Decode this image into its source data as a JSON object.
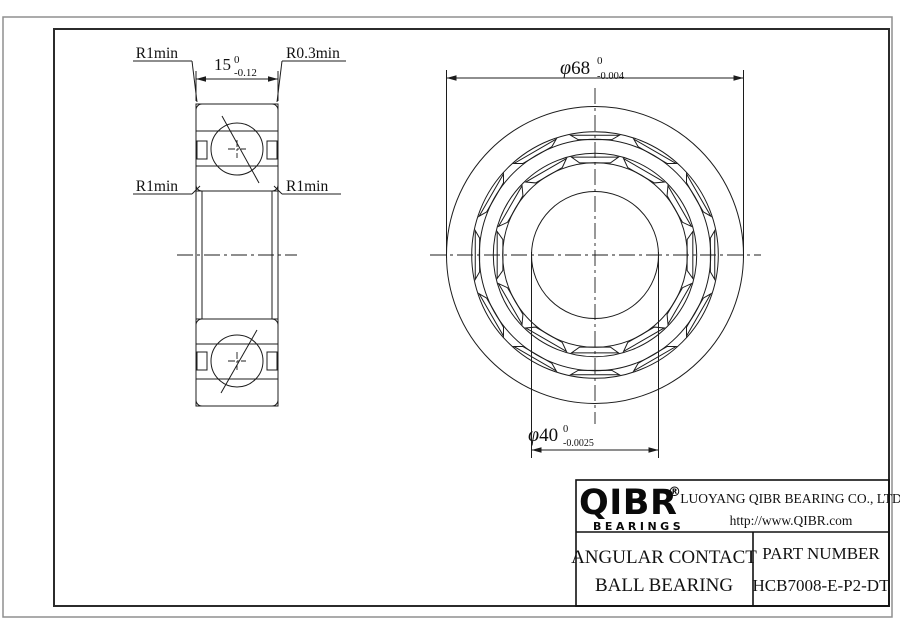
{
  "colors": {
    "line": "#1c1c1c",
    "frame_outer": "#8f8f8f",
    "frame_inner": "#2b2b2b",
    "background": "#ffffff"
  },
  "side_view": {
    "width_dim": {
      "nominal": "15",
      "tol_upper": "0",
      "tol_lower": "-0.12"
    },
    "fillet_labels": {
      "top_left": "R1min",
      "top_right": "R0.3min",
      "mid_left": "R1min",
      "mid_right": "R1min"
    }
  },
  "front_view": {
    "outer_dia": {
      "symbol": "φ",
      "nominal": "68",
      "tol_upper": "0",
      "tol_lower": "-0.004"
    },
    "bore_dia": {
      "symbol": "φ",
      "nominal": "40",
      "tol_upper": "0",
      "tol_lower": "-0.0025"
    }
  },
  "title_block": {
    "logo_text": "QIBR",
    "logo_registered": "®",
    "logo_subtext": "BEARINGS",
    "company": "LUOYANG QIBR BEARING CO., LTD",
    "website": "http://www.QIBR.com",
    "product_name_line1": "ANGULAR CONTACT",
    "product_name_line2": "BALL BEARING",
    "part_number_label": "PART NUMBER",
    "part_number": "HCB7008-E-P2-DT"
  }
}
